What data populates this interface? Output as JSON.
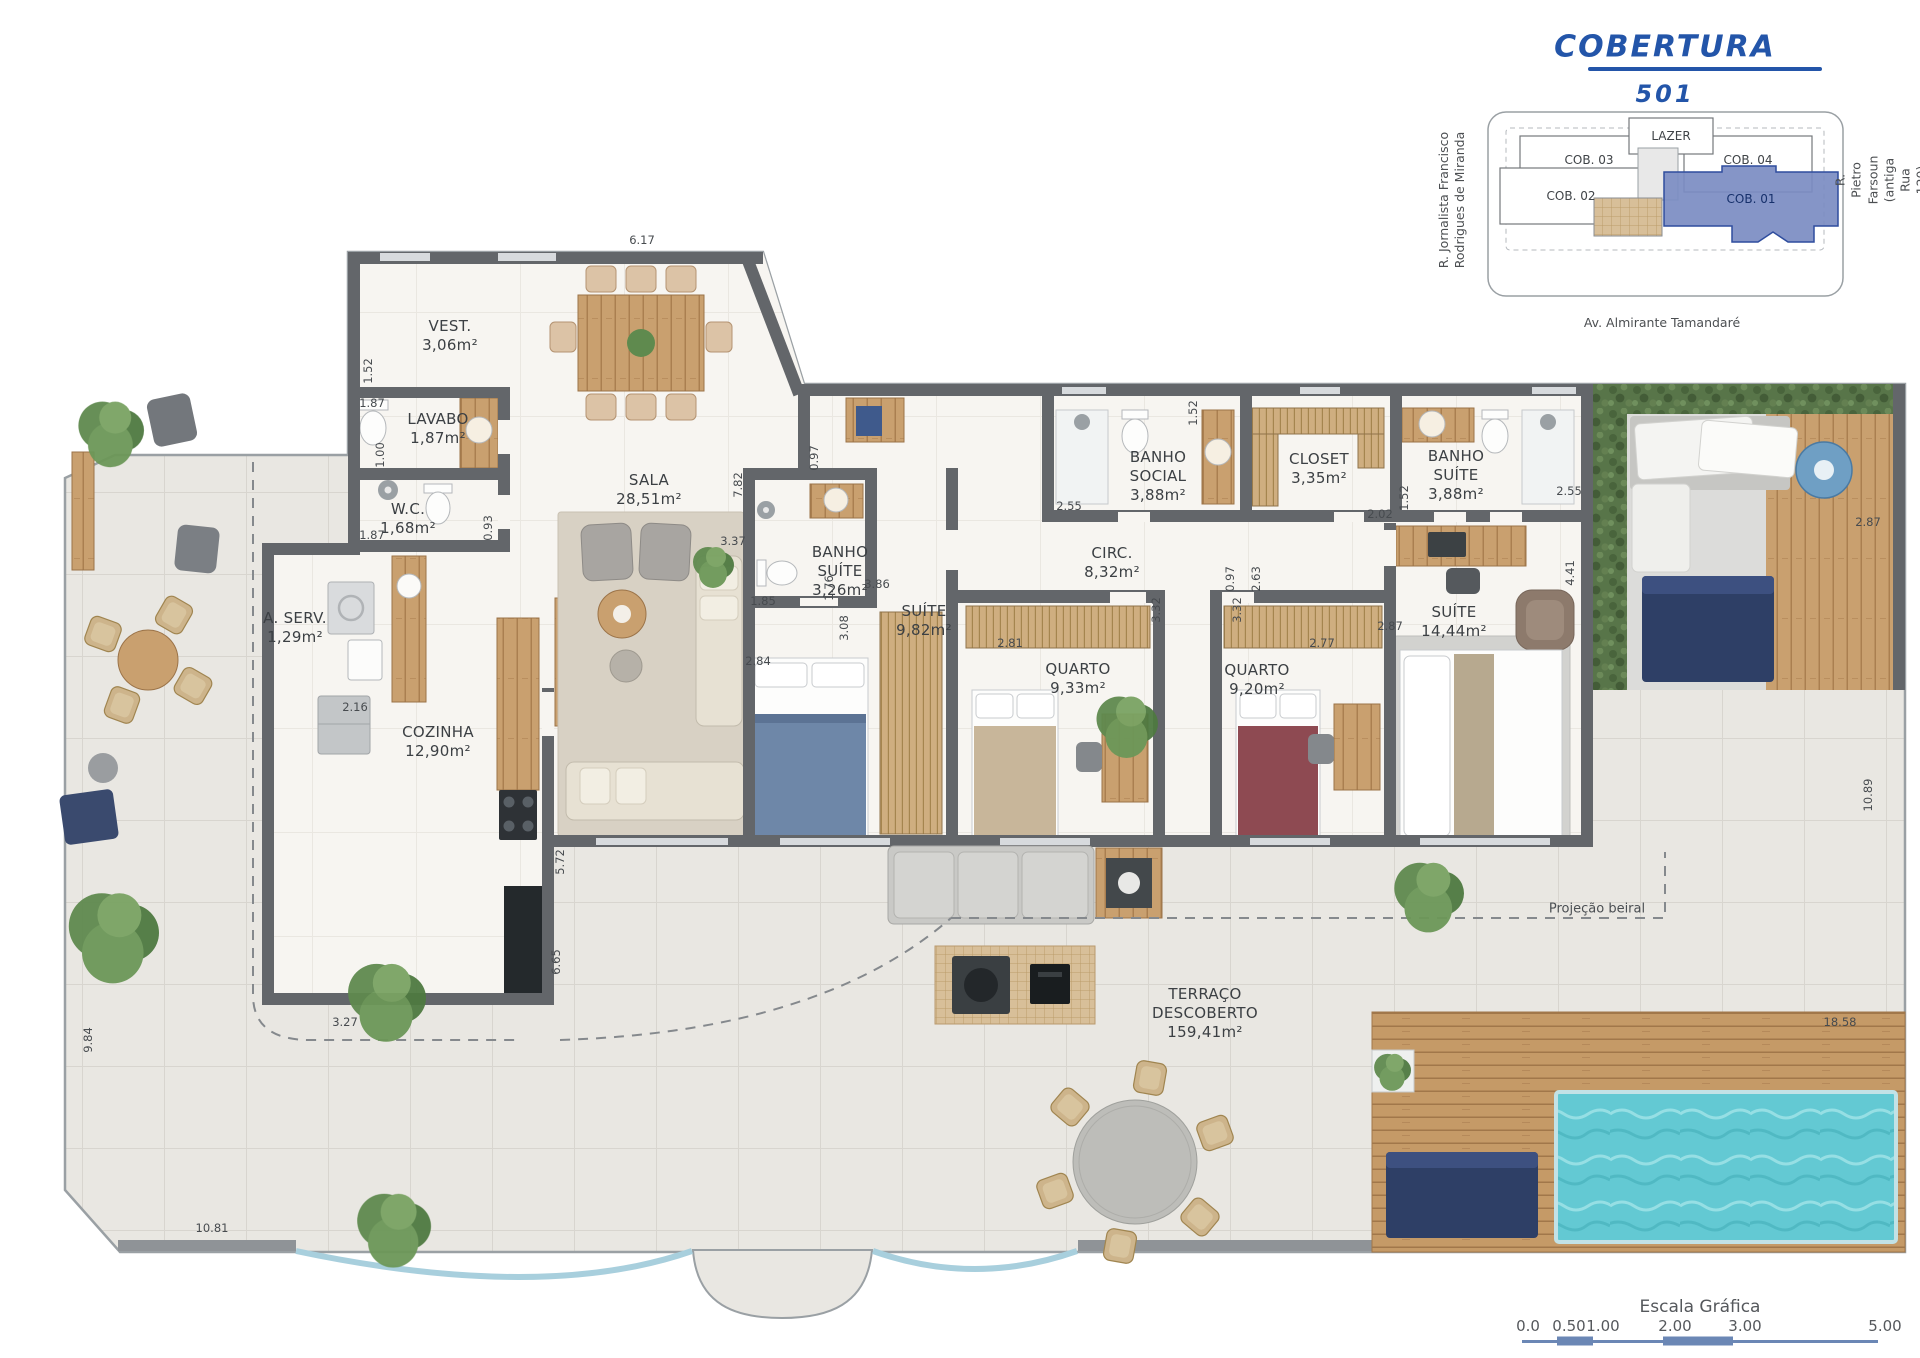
{
  "title": {
    "main": "COBERTURA",
    "unit": "501"
  },
  "keyplan": {
    "units": [
      {
        "label": "COB. 03",
        "highlighted": false
      },
      {
        "label": "COB. 04",
        "highlighted": false
      },
      {
        "label": "COB. 02",
        "highlighted": false
      },
      {
        "label": "COB. 01",
        "highlighted": true
      },
      {
        "label": "LAZER",
        "highlighted": false
      }
    ],
    "streets": {
      "left": "R. Jornalista Francisco\nRodrigues de Miranda",
      "right": "R. Pietro Farsoun\n(antiga Rua 120)",
      "bottom": "Av. Almirante Tamandaré"
    },
    "highlight_color": "#7b8cc2"
  },
  "plan": {
    "rooms": [
      {
        "id": "vest",
        "name": "VEST.",
        "area": "3,06m²",
        "x": 450,
        "y": 336
      },
      {
        "id": "lavabo",
        "name": "LAVABO",
        "area": "1,87m²",
        "x": 438,
        "y": 429
      },
      {
        "id": "wc",
        "name": "W.C.",
        "area": "1,68m²",
        "x": 408,
        "y": 519
      },
      {
        "id": "area-servico",
        "name": "A. SERV.",
        "area": "1,29m²",
        "x": 295,
        "y": 628
      },
      {
        "id": "cozinha",
        "name": "COZINHA",
        "area": "12,90m²",
        "x": 438,
        "y": 742
      },
      {
        "id": "sala",
        "name": "SALA",
        "area": "28,51m²",
        "x": 649,
        "y": 490
      },
      {
        "id": "banho-suite-1",
        "name": "BANHO\nSUÍTE",
        "area": "3,26m²",
        "x": 840,
        "y": 572
      },
      {
        "id": "suite-1",
        "name": "SUÍTE",
        "area": "9,82m²",
        "x": 924,
        "y": 621
      },
      {
        "id": "circ",
        "name": "CIRC.",
        "area": "8,32m²",
        "x": 1112,
        "y": 563
      },
      {
        "id": "quarto-1",
        "name": "QUARTO",
        "area": "9,33m²",
        "x": 1078,
        "y": 679
      },
      {
        "id": "banho-social",
        "name": "BANHO\nSOCIAL",
        "area": "3,88m²",
        "x": 1158,
        "y": 477
      },
      {
        "id": "closet",
        "name": "CLOSET",
        "area": "3,35m²",
        "x": 1319,
        "y": 469
      },
      {
        "id": "banho-suite-2",
        "name": "BANHO\nSUÍTE",
        "area": "3,88m²",
        "x": 1456,
        "y": 476
      },
      {
        "id": "quarto-2",
        "name": "QUARTO",
        "area": "9,20m²",
        "x": 1257,
        "y": 680
      },
      {
        "id": "suite-2",
        "name": "SUÍTE",
        "area": "14,44m²",
        "x": 1454,
        "y": 622
      },
      {
        "id": "terraco",
        "name": "TERRAÇO\nDESCOBERTO",
        "area": "159,41m²",
        "x": 1205,
        "y": 1014
      }
    ],
    "dimensions": [
      {
        "text": "6.17",
        "x": 642,
        "y": 240,
        "v": false
      },
      {
        "text": "1.52",
        "x": 368,
        "y": 371,
        "v": true
      },
      {
        "text": "1.87",
        "x": 372,
        "y": 403,
        "v": false
      },
      {
        "text": "1.00",
        "x": 380,
        "y": 455,
        "v": true
      },
      {
        "text": "1.87",
        "x": 372,
        "y": 535,
        "v": false
      },
      {
        "text": "0.93",
        "x": 488,
        "y": 528,
        "v": true
      },
      {
        "text": "2.16",
        "x": 355,
        "y": 707,
        "v": false
      },
      {
        "text": "5.72",
        "x": 560,
        "y": 862,
        "v": true
      },
      {
        "text": "6.65",
        "x": 556,
        "y": 962,
        "v": true
      },
      {
        "text": "3.27",
        "x": 345,
        "y": 1022,
        "v": false
      },
      {
        "text": "9.84",
        "x": 88,
        "y": 1040,
        "v": true
      },
      {
        "text": "10.81",
        "x": 212,
        "y": 1228,
        "v": false
      },
      {
        "text": "7.82",
        "x": 738,
        "y": 485,
        "v": true
      },
      {
        "text": "0.97",
        "x": 814,
        "y": 458,
        "v": true
      },
      {
        "text": "3.37",
        "x": 733,
        "y": 541,
        "v": false
      },
      {
        "text": "1.85",
        "x": 763,
        "y": 601,
        "v": false
      },
      {
        "text": "1.76",
        "x": 829,
        "y": 588,
        "v": true
      },
      {
        "text": "3.08",
        "x": 844,
        "y": 628,
        "v": true
      },
      {
        "text": "2.84",
        "x": 758,
        "y": 661,
        "v": false
      },
      {
        "text": "3.86",
        "x": 877,
        "y": 584,
        "v": false
      },
      {
        "text": "2.81",
        "x": 1010,
        "y": 643,
        "v": false
      },
      {
        "text": "2.55",
        "x": 1069,
        "y": 506,
        "v": false
      },
      {
        "text": "1.52",
        "x": 1193,
        "y": 413,
        "v": true
      },
      {
        "text": "3.32",
        "x": 1156,
        "y": 610,
        "v": true
      },
      {
        "text": "0.97",
        "x": 1230,
        "y": 579,
        "v": true
      },
      {
        "text": "2.63",
        "x": 1256,
        "y": 579,
        "v": true
      },
      {
        "text": "3.32",
        "x": 1237,
        "y": 610,
        "v": true
      },
      {
        "text": "2.02",
        "x": 1380,
        "y": 514,
        "v": false
      },
      {
        "text": "1.52",
        "x": 1404,
        "y": 498,
        "v": true
      },
      {
        "text": "2.55",
        "x": 1569,
        "y": 491,
        "v": false
      },
      {
        "text": "2.87",
        "x": 1390,
        "y": 626,
        "v": false
      },
      {
        "text": "2.77",
        "x": 1322,
        "y": 643,
        "v": false
      },
      {
        "text": "4.41",
        "x": 1570,
        "y": 573,
        "v": true
      },
      {
        "text": "2.87",
        "x": 1868,
        "y": 522,
        "v": false
      },
      {
        "text": "10.89",
        "x": 1868,
        "y": 795,
        "v": true
      },
      {
        "text": "18.58",
        "x": 1840,
        "y": 1022,
        "v": false
      }
    ],
    "annotations": {
      "eave": "Projeção beiral"
    }
  },
  "scalebar": {
    "title": "Escala Gráfica",
    "ticks": [
      "0.0",
      "0.50",
      "1.00",
      "2.00",
      "3.00",
      "5.00"
    ]
  },
  "colors": {
    "accent_blue": "#2355a9",
    "wall": "#63666a",
    "pool_water": "#63c9d3",
    "hedge": "#587549",
    "keyplan_highlight": "#7b8cc2",
    "scalebar": "#6b87b5"
  }
}
